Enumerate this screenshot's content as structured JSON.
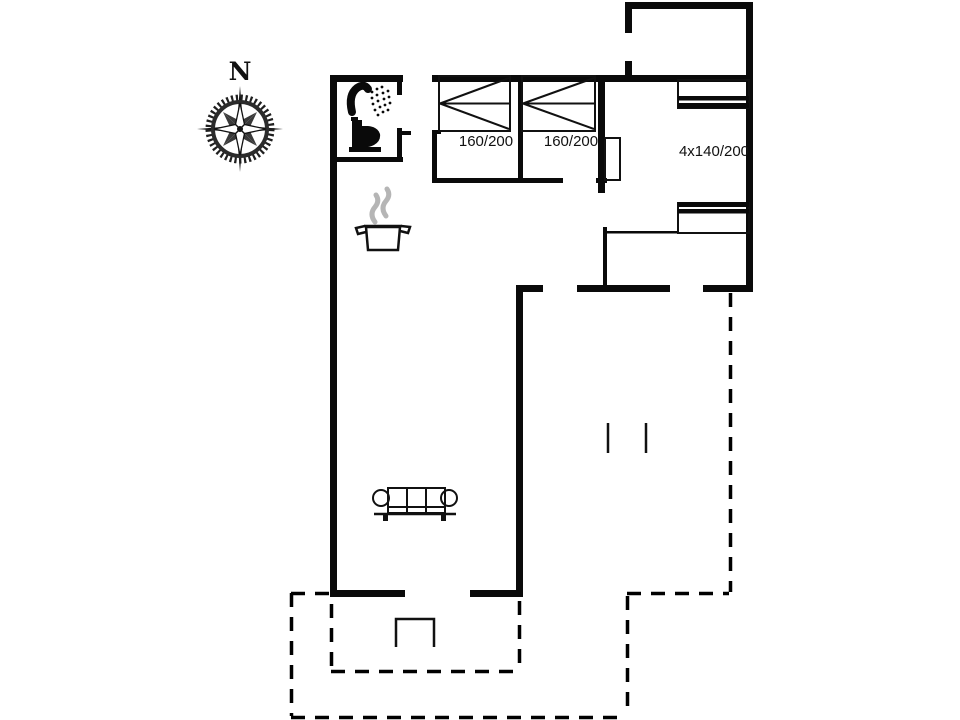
{
  "compass": {
    "label": "N"
  },
  "labels": {
    "bedroom1_bed": "160/200",
    "bedroom2_bed": "160/200",
    "bunk_room_beds": "4x140/200"
  },
  "colors": {
    "wall": "#0a0a0a",
    "line": "#111111",
    "steam": "#b5b5b5",
    "background": "#ffffff"
  },
  "icons": [
    "compass-rose-icon",
    "shower-icon",
    "toilet-icon",
    "cooking-pot-icon",
    "steam-icon",
    "double-bed-icon",
    "bunk-bed-icon",
    "sofa-icon",
    "terrace-steps-icon"
  ]
}
